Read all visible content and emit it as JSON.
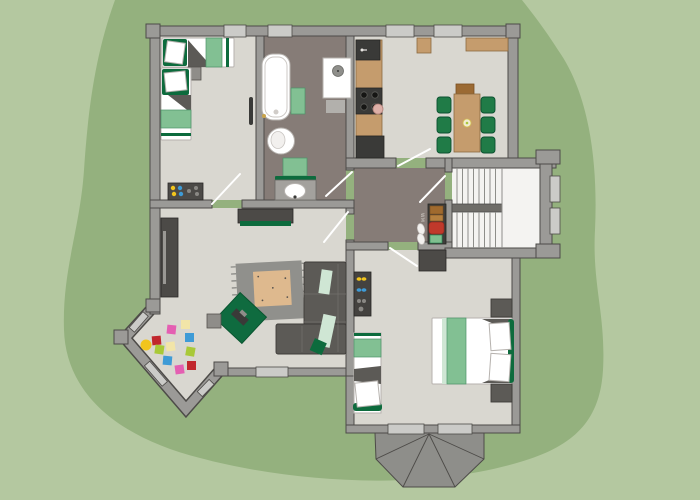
{
  "labels": {
    "washing_machine": "WM"
  },
  "palette": {
    "c-bg": "#b4c8a0",
    "c-lawn": "#94b17e",
    "c-wall": "#9b9a97",
    "c-wall-line": "#4d4b48",
    "c-floor": "#d9d7d0",
    "c-floor-dark": "#867c77",
    "c-stair": "#f4f3f1",
    "c-window": "#cbcbc8",
    "c-furn": "#4c4a47",
    "c-wood": "#c59c6d",
    "c-sofa": "#5c5a56",
    "c-chair": "#207b47",
    "c-green-dark": "#0d6b3d",
    "c-green-mid": "#82c093",
    "c-green-pale": "#cfe6d4",
    "c-carpet": "#90908c",
    "c-carpet-mid": "#deb98e",
    "c-roof": "#8e8e8a",
    "c-toy-pink": "#e45fb2",
    "c-toy-red": "#c1272d",
    "c-toy-yellow": "#f2c51d",
    "c-toy-pale": "#f2e5a8",
    "c-toy-lime": "#a9c938",
    "c-toy-blue": "#3e9bd6"
  }
}
